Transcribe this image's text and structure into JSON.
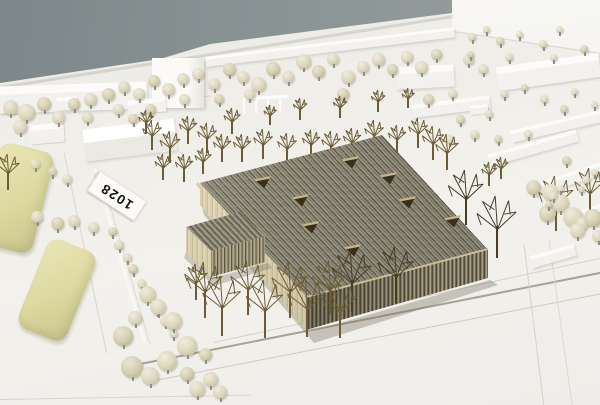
{
  "sticker": {
    "text": "1028"
  },
  "palette": {
    "backdrop_wall": "#8b9598",
    "baseboard_white": "#f0eee9",
    "timber_roof": "#8b8674",
    "timber_facade": "#857c64",
    "timber_light_face": "#d9cfae",
    "foliage_puff": "#dcd6bd",
    "foliage_foam": "#ddd8a0",
    "bare_tree": "#6d5d36",
    "label_text": "#141414"
  },
  "scene": {
    "roads": [
      [
        0,
        86,
        458,
        -8.9,
        2.5,
        "rgba(0,0,0,0.10)"
      ],
      [
        0,
        114,
        212,
        -5,
        1,
        "#dcd9d2"
      ],
      [
        452,
        31,
        150,
        8.4,
        1,
        "#d9d6cf"
      ],
      [
        64,
        152,
        205,
        78,
        1,
        "#d8d4cb"
      ],
      [
        100,
        170,
        180,
        74,
        1,
        "#dedacf"
      ],
      [
        0,
        399,
        250,
        -1,
        1.2,
        "#d8d4ca"
      ],
      [
        140,
        363,
        470,
        -11.2,
        1.5,
        "#a9a294"
      ],
      [
        150,
        381,
        460,
        -11,
        1.2,
        "#cfcabe"
      ],
      [
        214,
        342,
        395,
        -12.3,
        1,
        "#d5d1c6"
      ],
      [
        524,
        244,
        163,
        83,
        1,
        "#d5d1c6"
      ],
      [
        549,
        240,
        170,
        82,
        1,
        "#dcd8ce"
      ]
    ],
    "buildings": [
      [
        "bar",
        0,
        84,
        147,
        27,
        -2
      ],
      [
        "slab",
        152,
        58,
        52,
        50,
        0
      ],
      [
        "bar",
        205,
        42,
        250,
        10,
        -6.8
      ],
      [
        "bar",
        396,
        66,
        58,
        22,
        -3
      ],
      [
        "bar",
        412,
        100,
        78,
        13,
        -7
      ],
      [
        "bar",
        497,
        60,
        103,
        24,
        -8
      ],
      [
        "bar",
        510,
        120,
        95,
        12,
        -13
      ],
      [
        "bar",
        487,
        142,
        92,
        12,
        -16
      ],
      [
        "bar",
        530,
        173,
        78,
        12,
        -18
      ],
      [
        "bar",
        573,
        203,
        60,
        12,
        -18
      ],
      [
        "bar",
        530,
        250,
        46,
        12,
        -16
      ],
      [
        "cube",
        432,
        220,
        22,
        11,
        -12
      ],
      [
        "cube",
        470,
        105,
        18,
        9,
        -6
      ],
      [
        "house",
        84,
        124,
        92,
        32,
        -7
      ],
      [
        "cube",
        30,
        124,
        34,
        19,
        -5
      ],
      [
        "cube",
        57,
        97,
        20,
        13,
        -4
      ],
      [
        "cube",
        128,
        99,
        38,
        14,
        -5
      ],
      [
        "pergola",
        243,
        96,
        46,
        14,
        -3
      ]
    ],
    "hedges": [
      [
        -12,
        146,
        56,
        104,
        14
      ],
      [
        31,
        242,
        52,
        96,
        22
      ]
    ],
    "skylights": [
      [
        262,
        182
      ],
      [
        300,
        200
      ],
      [
        310,
        227
      ],
      [
        350,
        162
      ],
      [
        352,
        250
      ],
      [
        388,
        178
      ],
      [
        407,
        202
      ],
      [
        452,
        221
      ]
    ],
    "puff_back": [
      [
        10,
        107,
        15
      ],
      [
        26,
        112,
        17
      ],
      [
        44,
        104,
        14
      ],
      [
        20,
        127,
        14
      ],
      [
        58,
        117,
        13
      ],
      [
        74,
        104,
        12
      ],
      [
        90,
        99,
        13
      ],
      [
        87,
        117,
        11
      ],
      [
        108,
        94,
        13
      ],
      [
        124,
        87,
        12
      ],
      [
        139,
        94,
        12
      ],
      [
        154,
        81,
        12
      ],
      [
        168,
        89,
        13
      ],
      [
        183,
        79,
        12
      ],
      [
        150,
        109,
        11
      ],
      [
        198,
        74,
        12
      ],
      [
        214,
        84,
        12
      ],
      [
        229,
        69,
        13
      ],
      [
        243,
        77,
        12
      ],
      [
        258,
        84,
        15
      ],
      [
        273,
        69,
        14
      ],
      [
        288,
        77,
        12
      ],
      [
        303,
        61,
        15
      ],
      [
        318,
        71,
        13
      ],
      [
        333,
        59,
        12
      ],
      [
        348,
        77,
        14
      ],
      [
        343,
        94,
        12
      ],
      [
        363,
        67,
        12
      ],
      [
        378,
        59,
        13
      ],
      [
        392,
        69,
        11
      ],
      [
        407,
        57,
        12
      ],
      [
        421,
        67,
        13
      ],
      [
        436,
        54,
        11
      ],
      [
        468,
        59,
        11
      ],
      [
        483,
        69,
        10
      ],
      [
        428,
        99,
        11
      ],
      [
        452,
        93,
        9
      ],
      [
        249,
        94,
        11
      ],
      [
        219,
        99,
        10
      ],
      [
        184,
        99,
        11
      ],
      [
        118,
        109,
        11
      ],
      [
        133,
        119,
        10
      ],
      [
        472,
        37,
        8
      ],
      [
        486,
        29,
        7
      ],
      [
        500,
        41,
        8
      ],
      [
        519,
        34,
        7
      ],
      [
        543,
        44,
        8
      ],
      [
        470,
        54,
        7
      ],
      [
        509,
        57,
        8
      ],
      [
        553,
        57,
        7
      ],
      [
        584,
        49,
        8
      ],
      [
        559,
        29,
        7
      ],
      [
        504,
        94,
        8
      ],
      [
        524,
        87,
        7
      ],
      [
        544,
        99,
        8
      ],
      [
        574,
        91,
        7
      ],
      [
        564,
        109,
        8
      ],
      [
        594,
        104,
        7
      ],
      [
        489,
        114,
        8
      ],
      [
        460,
        119,
        9
      ],
      [
        474,
        134,
        9
      ],
      [
        449,
        139,
        9
      ],
      [
        498,
        139,
        8
      ],
      [
        528,
        134,
        8
      ],
      [
        35,
        164,
        10
      ],
      [
        52,
        171,
        9
      ],
      [
        67,
        179,
        10
      ],
      [
        98,
        176,
        8
      ],
      [
        111,
        189,
        9
      ],
      [
        119,
        204,
        10
      ],
      [
        37,
        217,
        12
      ],
      [
        57,
        223,
        13
      ],
      [
        74,
        221,
        12
      ],
      [
        93,
        227,
        11
      ],
      [
        112,
        231,
        9
      ],
      [
        119,
        245,
        10
      ],
      [
        127,
        257,
        9
      ],
      [
        133,
        269,
        10
      ],
      [
        141,
        283,
        9
      ],
      [
        149,
        295,
        10
      ],
      [
        157,
        309,
        9
      ],
      [
        165,
        321,
        10
      ],
      [
        173,
        333,
        9
      ]
    ],
    "puff_front": [
      [
        147,
        294,
        17
      ],
      [
        158,
        307,
        16
      ],
      [
        123,
        336,
        20
      ],
      [
        173,
        321,
        18
      ],
      [
        187,
        346,
        20
      ],
      [
        132,
        367,
        22
      ],
      [
        167,
        361,
        20
      ],
      [
        150,
        376,
        18
      ],
      [
        187,
        374,
        14
      ],
      [
        197,
        389,
        16
      ],
      [
        210,
        379,
        15
      ],
      [
        205,
        354,
        13
      ],
      [
        220,
        392,
        14
      ],
      [
        135,
        318,
        14
      ],
      [
        533,
        187,
        15
      ],
      [
        550,
        192,
        17
      ],
      [
        560,
        203,
        18
      ],
      [
        547,
        213,
        17
      ],
      [
        573,
        217,
        20
      ],
      [
        582,
        223,
        13
      ],
      [
        593,
        218,
        18
      ],
      [
        577,
        230,
        15
      ],
      [
        598,
        236,
        12
      ],
      [
        566,
        160,
        9
      ],
      [
        553,
        196,
        8
      ],
      [
        560,
        188,
        7
      ],
      [
        548,
        204,
        7
      ],
      [
        586,
        180,
        8
      ],
      [
        594,
        172,
        7
      ],
      [
        581,
        189,
        7
      ]
    ],
    "wire_back": [
      [
        152,
        150,
        30
      ],
      [
        170,
        163,
        32
      ],
      [
        188,
        144,
        28
      ],
      [
        207,
        153,
        30
      ],
      [
        163,
        180,
        26
      ],
      [
        184,
        182,
        28
      ],
      [
        203,
        174,
        26
      ],
      [
        222,
        162,
        28
      ],
      [
        146,
        134,
        24
      ],
      [
        232,
        134,
        26
      ],
      [
        242,
        162,
        28
      ],
      [
        263,
        159,
        30
      ],
      [
        287,
        163,
        30
      ],
      [
        311,
        158,
        28
      ],
      [
        331,
        161,
        30
      ],
      [
        352,
        156,
        28
      ],
      [
        374,
        150,
        30
      ],
      [
        397,
        153,
        28
      ],
      [
        418,
        148,
        30
      ],
      [
        270,
        125,
        20
      ],
      [
        300,
        120,
        22
      ],
      [
        340,
        118,
        22
      ],
      [
        378,
        112,
        22
      ],
      [
        408,
        108,
        20
      ],
      [
        433,
        160,
        34
      ],
      [
        447,
        170,
        36
      ],
      [
        489,
        186,
        24
      ],
      [
        501,
        179,
        22
      ],
      [
        8,
        190,
        36
      ],
      [
        556,
        231,
        55
      ],
      [
        590,
        216,
        48
      ]
    ],
    "wire_front": [
      [
        466,
        225,
        55,
        1
      ],
      [
        497,
        258,
        62,
        1
      ],
      [
        352,
        312,
        62,
        1
      ],
      [
        396,
        303,
        56,
        1
      ],
      [
        205,
        318,
        56,
        0
      ],
      [
        248,
        315,
        54,
        0
      ],
      [
        290,
        318,
        56,
        0
      ],
      [
        330,
        315,
        54,
        0
      ],
      [
        222,
        336,
        60,
        0
      ],
      [
        265,
        338,
        58,
        0
      ],
      [
        307,
        337,
        60,
        0
      ],
      [
        340,
        338,
        56,
        0
      ],
      [
        196,
        300,
        36,
        0
      ]
    ]
  }
}
